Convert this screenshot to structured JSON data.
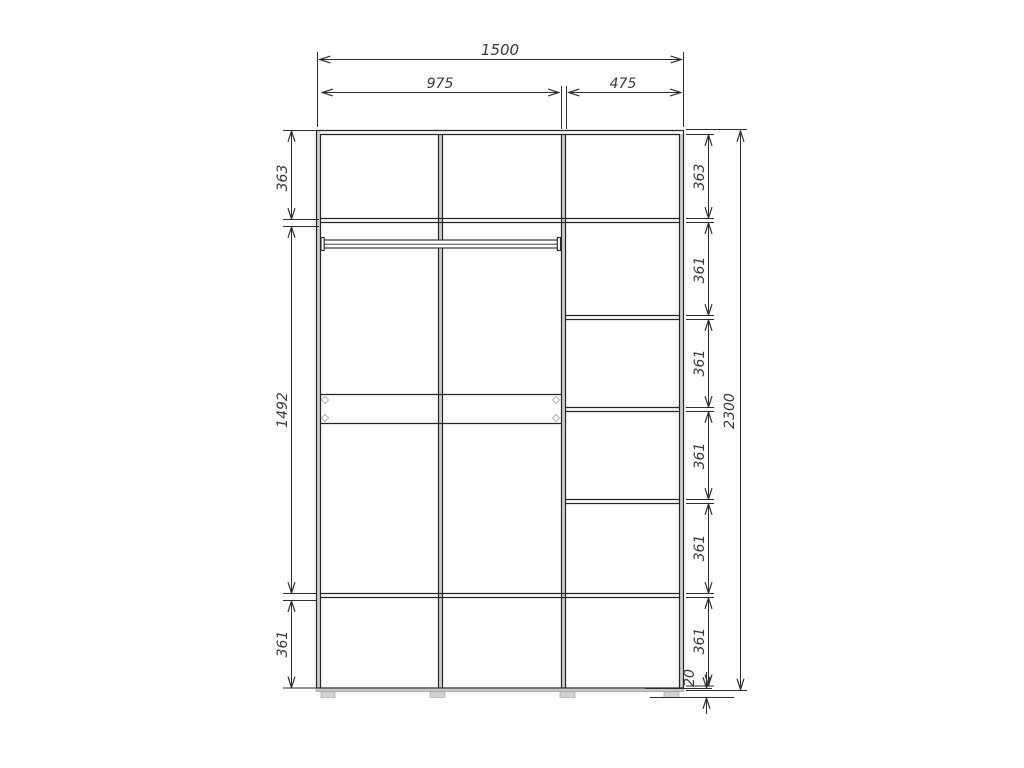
{
  "drawing": {
    "kind": "wardrobe-front-elevation-technical-drawing",
    "units": "mm",
    "dims": {
      "top": {
        "total": "1500",
        "left_section": "975",
        "right_section": "475"
      },
      "left": {
        "top": "363",
        "middle": "1492",
        "bottom": "361"
      },
      "right": {
        "segments": [
          "363",
          "361",
          "361",
          "361",
          "361",
          "361"
        ],
        "total": "2300",
        "plinth": "20"
      }
    }
  }
}
